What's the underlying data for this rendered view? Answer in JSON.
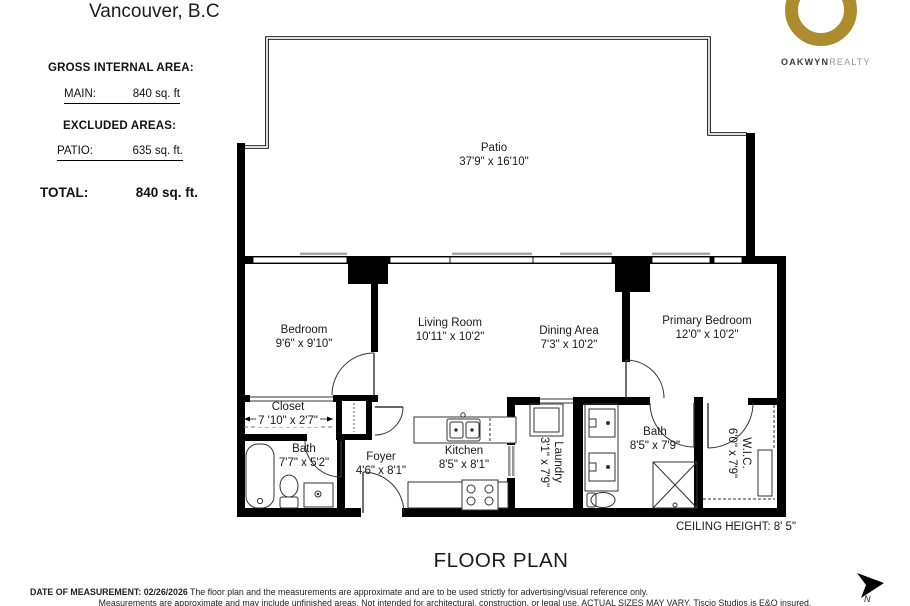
{
  "title": "Vancouver, B.C",
  "logo": {
    "brand_bold": "OAKWYN",
    "brand_light": "REALTY",
    "ring_color": "#AD8C2D"
  },
  "area_summary": {
    "gross_label": "GROSS INTERNAL AREA:",
    "main_label": "MAIN:",
    "main_value": "840 sq. ft",
    "excluded_label": "EXCLUDED AREAS:",
    "patio_label": "PATIO:",
    "patio_value": "635 sq. ft.",
    "total_label": "TOTAL:",
    "total_value": "840 sq. ft."
  },
  "rooms": {
    "patio": {
      "name": "Patio",
      "dims": "37'9\" x 16'10\""
    },
    "bedroom": {
      "name": "Bedroom",
      "dims": "9'6\" x 9'10\""
    },
    "living_room": {
      "name": "Living Room",
      "dims": "10'11\" x 10'2\""
    },
    "dining_area": {
      "name": "Dining Area",
      "dims": "7'3\" x 10'2\""
    },
    "primary_bedroom": {
      "name": "Primary Bedroom",
      "dims": "12'0\" x 10'2\""
    },
    "closet": {
      "name": "Closet",
      "dims": "7 '10\" x 2'7\""
    },
    "bath1": {
      "name": "Bath",
      "dims": "7'7\" x 5'2\""
    },
    "foyer": {
      "name": "Foyer",
      "dims": "4'6\" x 8'1\""
    },
    "kitchen": {
      "name": "Kitchen",
      "dims": "8'5\" x 8'1\""
    },
    "laundry": {
      "name": "Laundry",
      "dims": "3'1\" x 7'9\""
    },
    "bath2": {
      "name": "Bath",
      "dims": "8'5\" x 7'9\""
    },
    "wic": {
      "name": "W.I.C.",
      "dims": "6'0\" x 7'9\""
    }
  },
  "plan": {
    "ceiling_note": "CEILING HEIGHT: 8' 5\"",
    "title": "FLOOR PLAN",
    "compass": "N"
  },
  "footer": {
    "line1_bold": "DATE OF  MEASUREMENT: 02/26/2026",
    "line1_rest": "The floor plan and the measurements are approximate and are to be used strictly for advertising/visual reference only.",
    "line2": "Measurements are approximate and may include unfinished areas. Not intended for architectural, construction, or legal use. ACTUAL SIZES MAY VARY. Tiscio Studios is E&O insured."
  }
}
